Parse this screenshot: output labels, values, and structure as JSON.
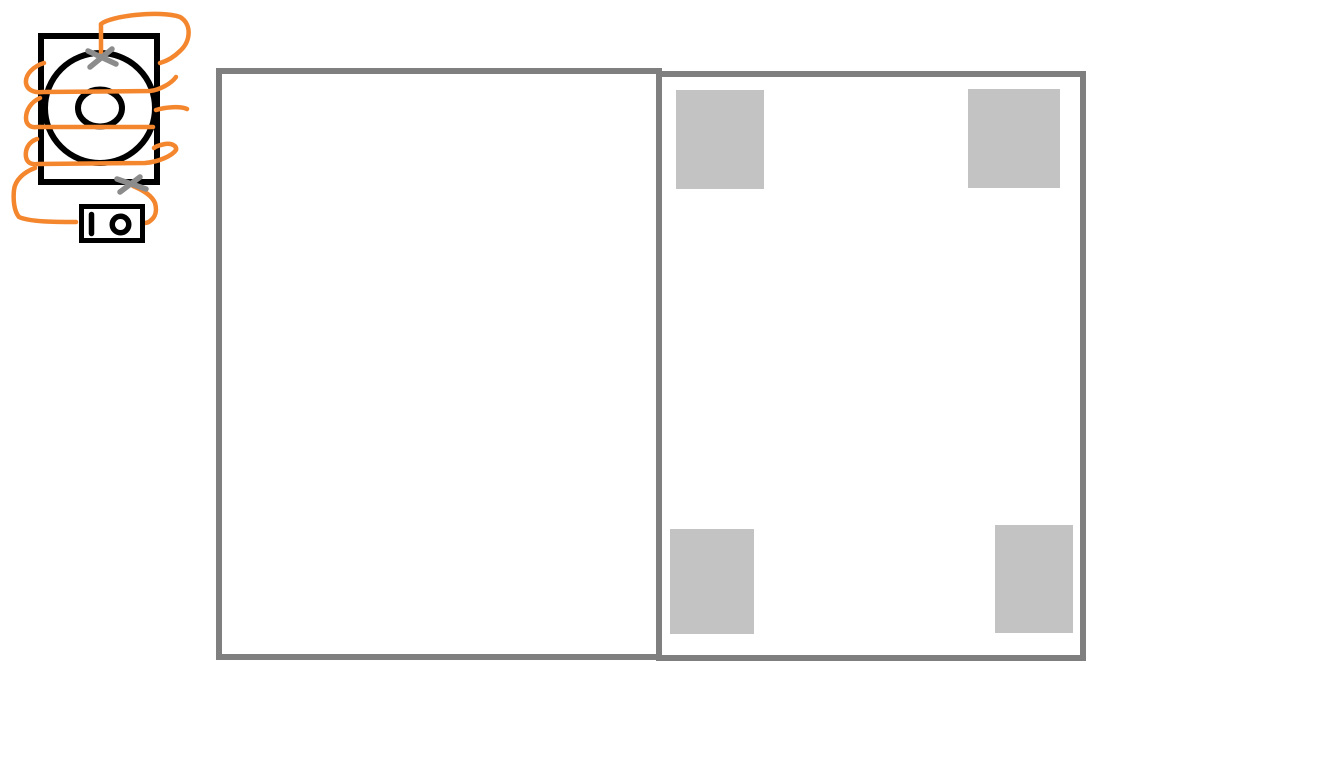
{
  "canvas": {
    "width": 1329,
    "height": 778,
    "background": "#ffffff"
  },
  "colors": {
    "ink": "#000000",
    "wire-orange": "#f4862e",
    "mark-gray": "#8c8c8c",
    "panel-border": "#7f7f7f",
    "placeholder-gray": "#c3c3c3"
  },
  "sketch": {
    "description": "hand-drawn speaker (box with concentric circles) wrapped by an orange wire coil, two gray X terminal marks, wire leading to a power switch with I/O symbols",
    "elements": [
      "speaker-box",
      "speaker-cone-outer",
      "speaker-cone-inner",
      "wire-coil",
      "terminal-x-top",
      "terminal-x-bottom",
      "power-switch-body",
      "switch-on-symbol",
      "switch-off-symbol"
    ]
  },
  "panels": {
    "left": {
      "x": 216,
      "y": 68,
      "width": 446,
      "height": 592
    },
    "right": {
      "x": 656,
      "y": 71,
      "width": 430,
      "height": 590,
      "squares": [
        {
          "x": 676,
          "y": 90,
          "width": 88,
          "height": 99
        },
        {
          "x": 968,
          "y": 89,
          "width": 92,
          "height": 99
        },
        {
          "x": 670,
          "y": 529,
          "width": 84,
          "height": 105
        },
        {
          "x": 995,
          "y": 525,
          "width": 78,
          "height": 108
        }
      ]
    }
  }
}
